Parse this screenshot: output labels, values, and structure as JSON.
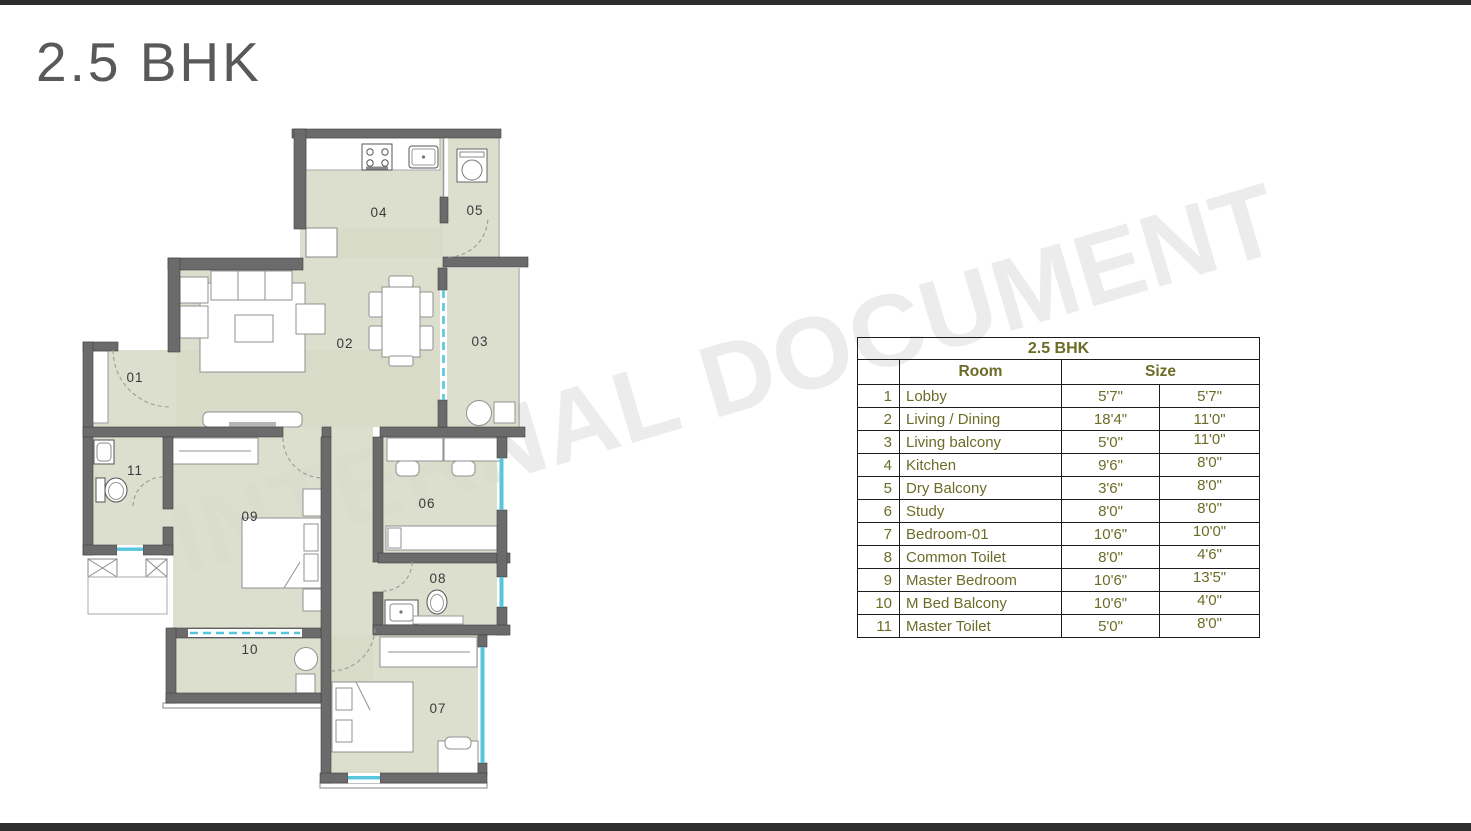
{
  "page_title": "2.5 BHK",
  "watermark": "INTERNAL DOCUMENT",
  "colors": {
    "wall": "#6b6b6b",
    "floor": "#d7dbc7",
    "window": "#55c6dc",
    "table_text": "#6c6c28",
    "title_text": "#58595b",
    "watermark_gray": "#ececec"
  },
  "plan": {
    "labels": {
      "r01": "01",
      "r02": "02",
      "r03": "03",
      "r04": "04",
      "r05": "05",
      "r06": "06",
      "r07": "07",
      "r08": "08",
      "r09": "09",
      "r10": "10",
      "r11": "11"
    }
  },
  "table": {
    "title": "2.5 BHK",
    "col_room": "Room",
    "col_size": "Size",
    "rows": [
      {
        "no": "1",
        "room": "Lobby",
        "w": "5'7\"",
        "h": "5'7\""
      },
      {
        "no": "2",
        "room": "Living / Dining",
        "w": "18'4\"",
        "h": "11'0\""
      },
      {
        "no": "3",
        "room": "Living balcony",
        "w": "5'0\"",
        "h": "11'0\""
      },
      {
        "no": "4",
        "room": "Kitchen",
        "w": "9'6\"",
        "h": "8'0\""
      },
      {
        "no": "5",
        "room": "Dry Balcony",
        "w": "3'6\"",
        "h": "8'0\""
      },
      {
        "no": "6",
        "room": "Study",
        "w": "8'0\"",
        "h": "8'0\""
      },
      {
        "no": "7",
        "room": "Bedroom-01",
        "w": "10'6\"",
        "h": "10'0\""
      },
      {
        "no": "8",
        "room": "Common Toilet",
        "w": "8'0\"",
        "h": "4'6\""
      },
      {
        "no": "9",
        "room": "Master Bedroom",
        "w": "10'6\"",
        "h": "13'5\""
      },
      {
        "no": "10",
        "room": "M Bed Balcony",
        "w": "10'6\"",
        "h": "4'0\""
      },
      {
        "no": "11",
        "room": "Master Toilet",
        "w": "5'0\"",
        "h": "8'0\""
      }
    ]
  }
}
